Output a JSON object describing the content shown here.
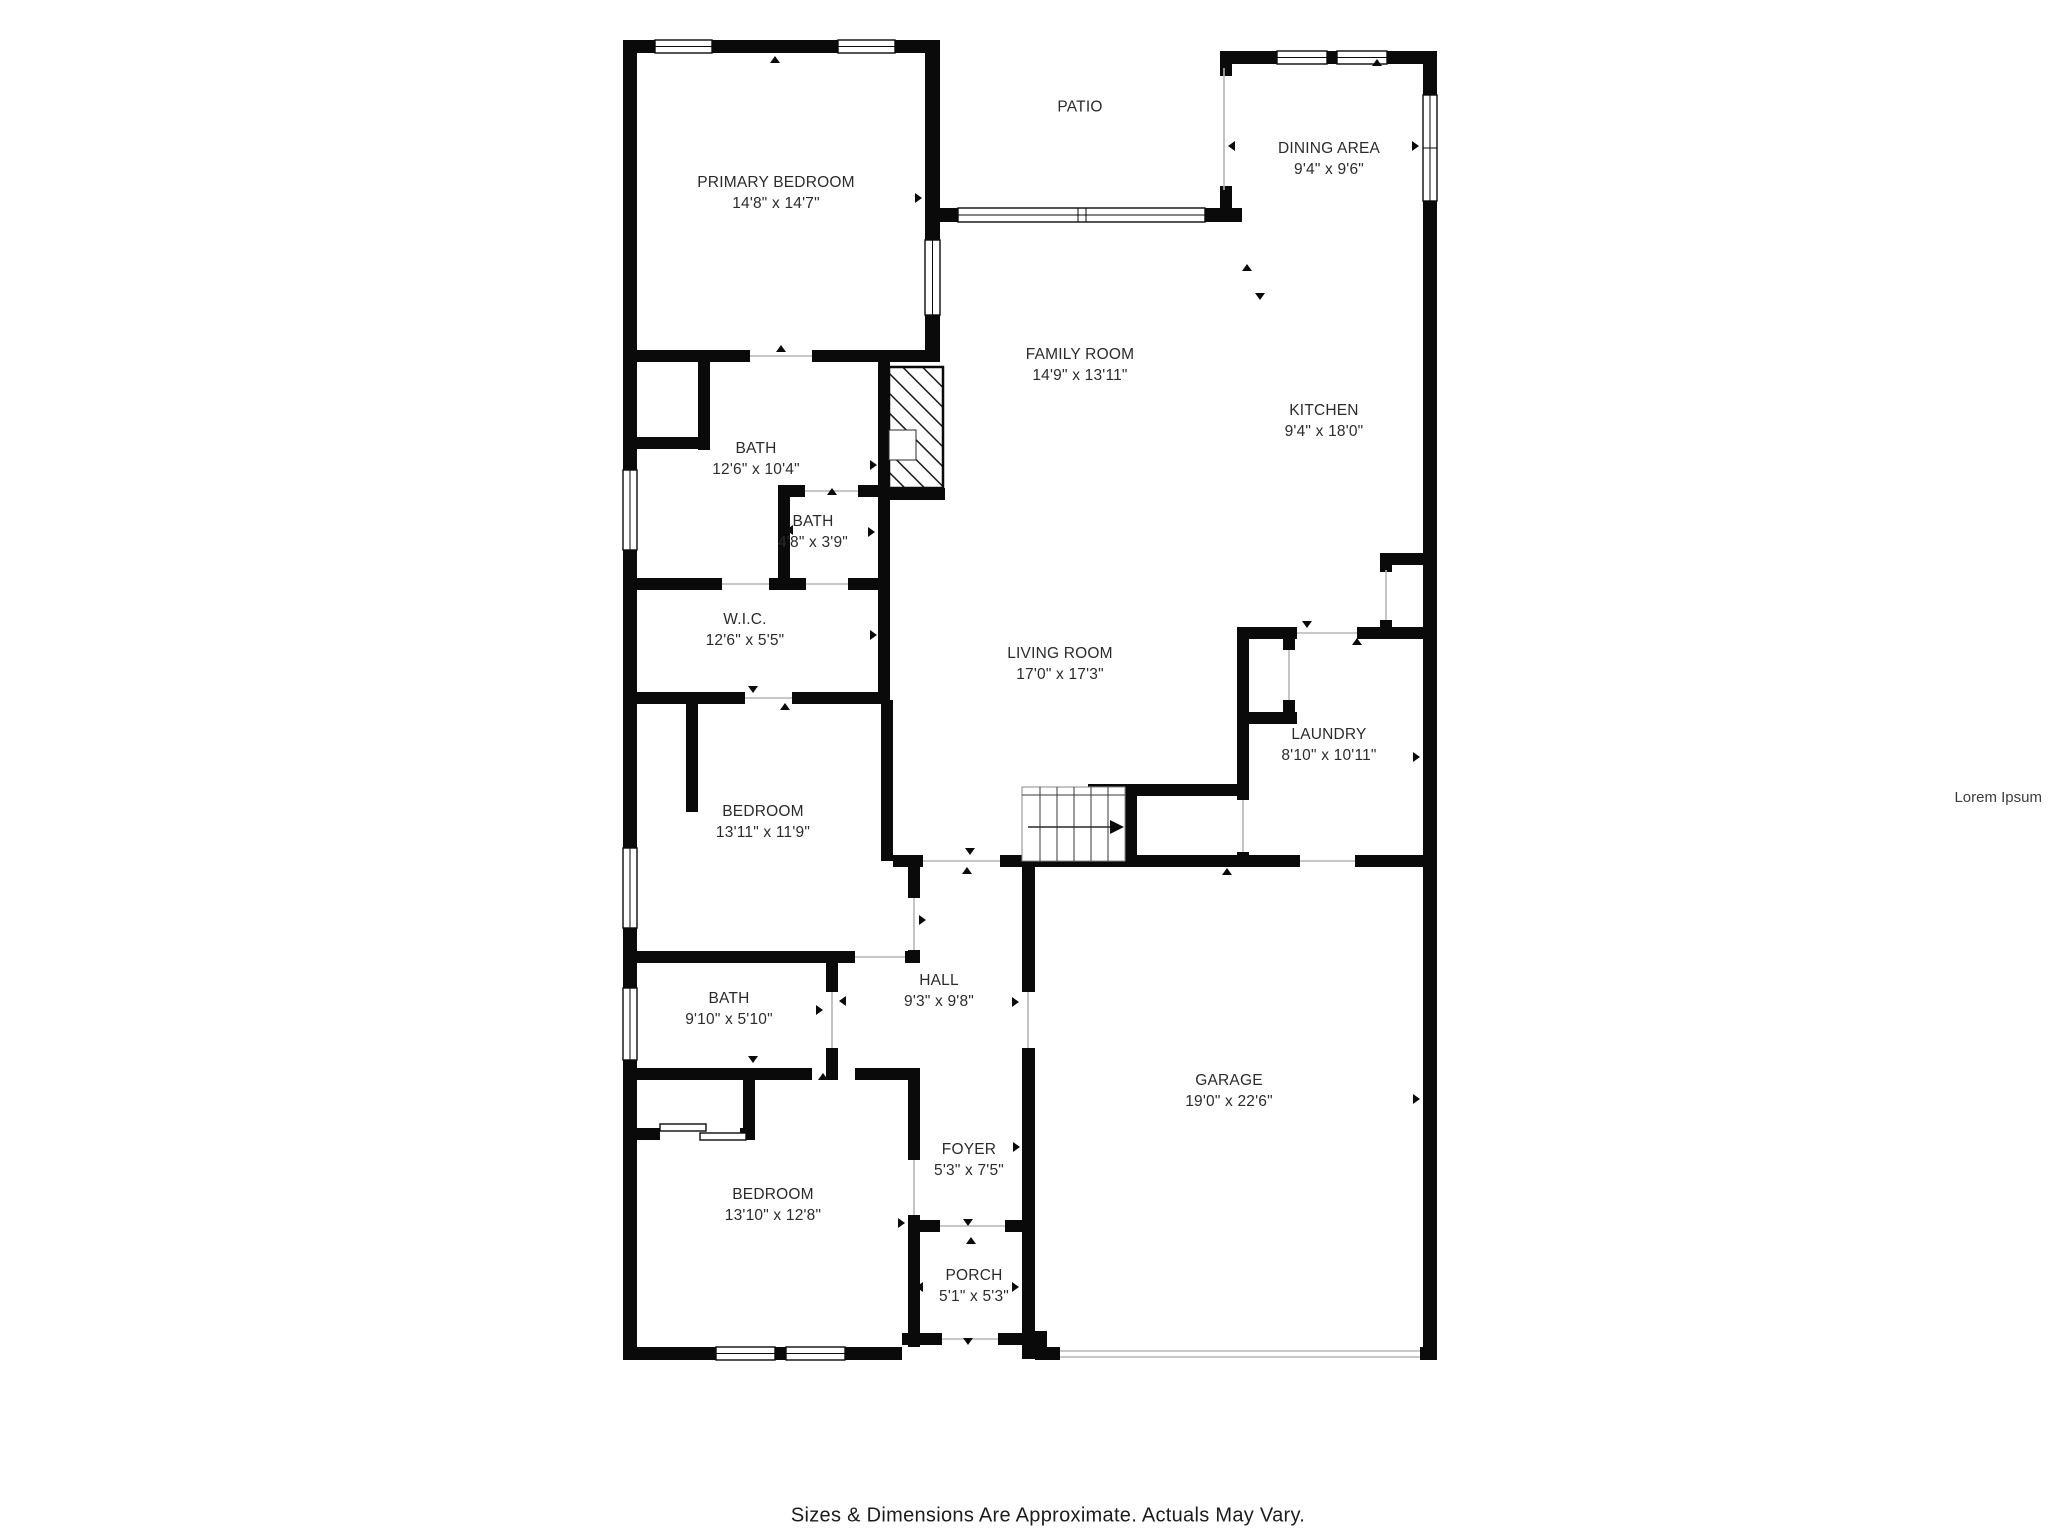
{
  "watermark": "Lorem Ipsum",
  "footer": {
    "disclaimer": "Sizes & Dimensions Are Approximate. Actuals May Vary."
  },
  "colors": {
    "wall-color": "#0a0a0a",
    "thin-color": "#b5b5b5",
    "text-color": "#2b2b2b",
    "bg-color": "#ffffff"
  },
  "rooms": [
    {
      "id": "patio",
      "name": "PATIO",
      "dims": ""
    },
    {
      "id": "primary-bedroom",
      "name": "PRIMARY BEDROOM",
      "dims": "14'8\" x 14'7\""
    },
    {
      "id": "dining-area",
      "name": "DINING AREA",
      "dims": "9'4\" x 9'6\""
    },
    {
      "id": "family-room",
      "name": "FAMILY ROOM",
      "dims": "14'9\" x 13'11\""
    },
    {
      "id": "kitchen",
      "name": "KITCHEN",
      "dims": "9'4\" x 18'0\""
    },
    {
      "id": "bath-primary",
      "name": "BATH",
      "dims": "12'6\" x 10'4\""
    },
    {
      "id": "bath-small",
      "name": "BATH",
      "dims": "4'8\" x 3'9\""
    },
    {
      "id": "wic",
      "name": "W.I.C.",
      "dims": "12'6\" x 5'5\""
    },
    {
      "id": "living-room",
      "name": "LIVING ROOM",
      "dims": "17'0\" x 17'3\""
    },
    {
      "id": "laundry",
      "name": "LAUNDRY",
      "dims": "8'10\" x 10'11\""
    },
    {
      "id": "bedroom-2",
      "name": "BEDROOM",
      "dims": "13'11\" x 11'9\""
    },
    {
      "id": "bath-hall",
      "name": "BATH",
      "dims": "9'10\" x 5'10\""
    },
    {
      "id": "hall",
      "name": "HALL",
      "dims": "9'3\" x 9'8\""
    },
    {
      "id": "garage",
      "name": "GARAGE",
      "dims": "19'0\" x 22'6\""
    },
    {
      "id": "foyer",
      "name": "FOYER",
      "dims": "5'3\" x 7'5\""
    },
    {
      "id": "bedroom-3",
      "name": "BEDROOM",
      "dims": "13'10\" x 12'8\""
    },
    {
      "id": "porch",
      "name": "PORCH",
      "dims": "5'1\" x 5'3\""
    }
  ]
}
